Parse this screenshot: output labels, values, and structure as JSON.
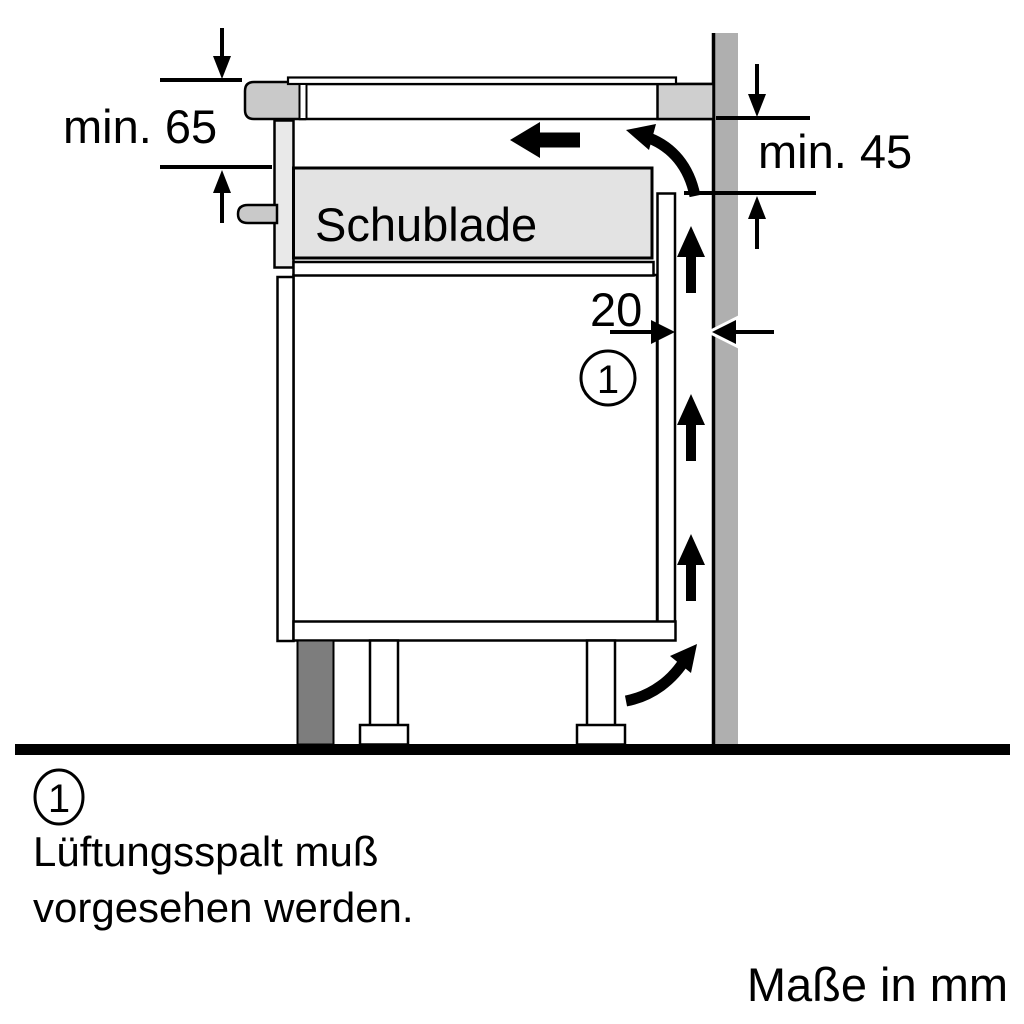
{
  "figure": {
    "type": "appliance-installation-side-section",
    "labels": {
      "min_top": "min. 65",
      "min_wall": "min. 45",
      "gap": "20",
      "drawer": "Schublade",
      "callout": "1"
    },
    "legend": {
      "callout": "1",
      "line1": "Lüftungsspalt muß",
      "line2": "vorgesehen werden."
    },
    "units": "Maße in mm",
    "colors": {
      "wall": "#afafaf",
      "worktop_end": "#cfcfcf",
      "hob_trim": "#c9c9c9",
      "handle": "#c9c9c9",
      "drawer_front": "#e9e9e9",
      "drawer_box": "#e3e3e3",
      "plinth": "#7d7d7d",
      "outline": "#000000",
      "background": "#ffffff"
    },
    "icons": {
      "airflow_up_arrow": "ventilation airflow upward (x3)",
      "airflow_left_arrow": "airflow under worktop",
      "airflow_curve_top": "airflow turning from gap under worktop",
      "airflow_curve_bottom": "airflow entering gap at plinth",
      "dimension_arrow": "dimension limit arrow"
    }
  }
}
